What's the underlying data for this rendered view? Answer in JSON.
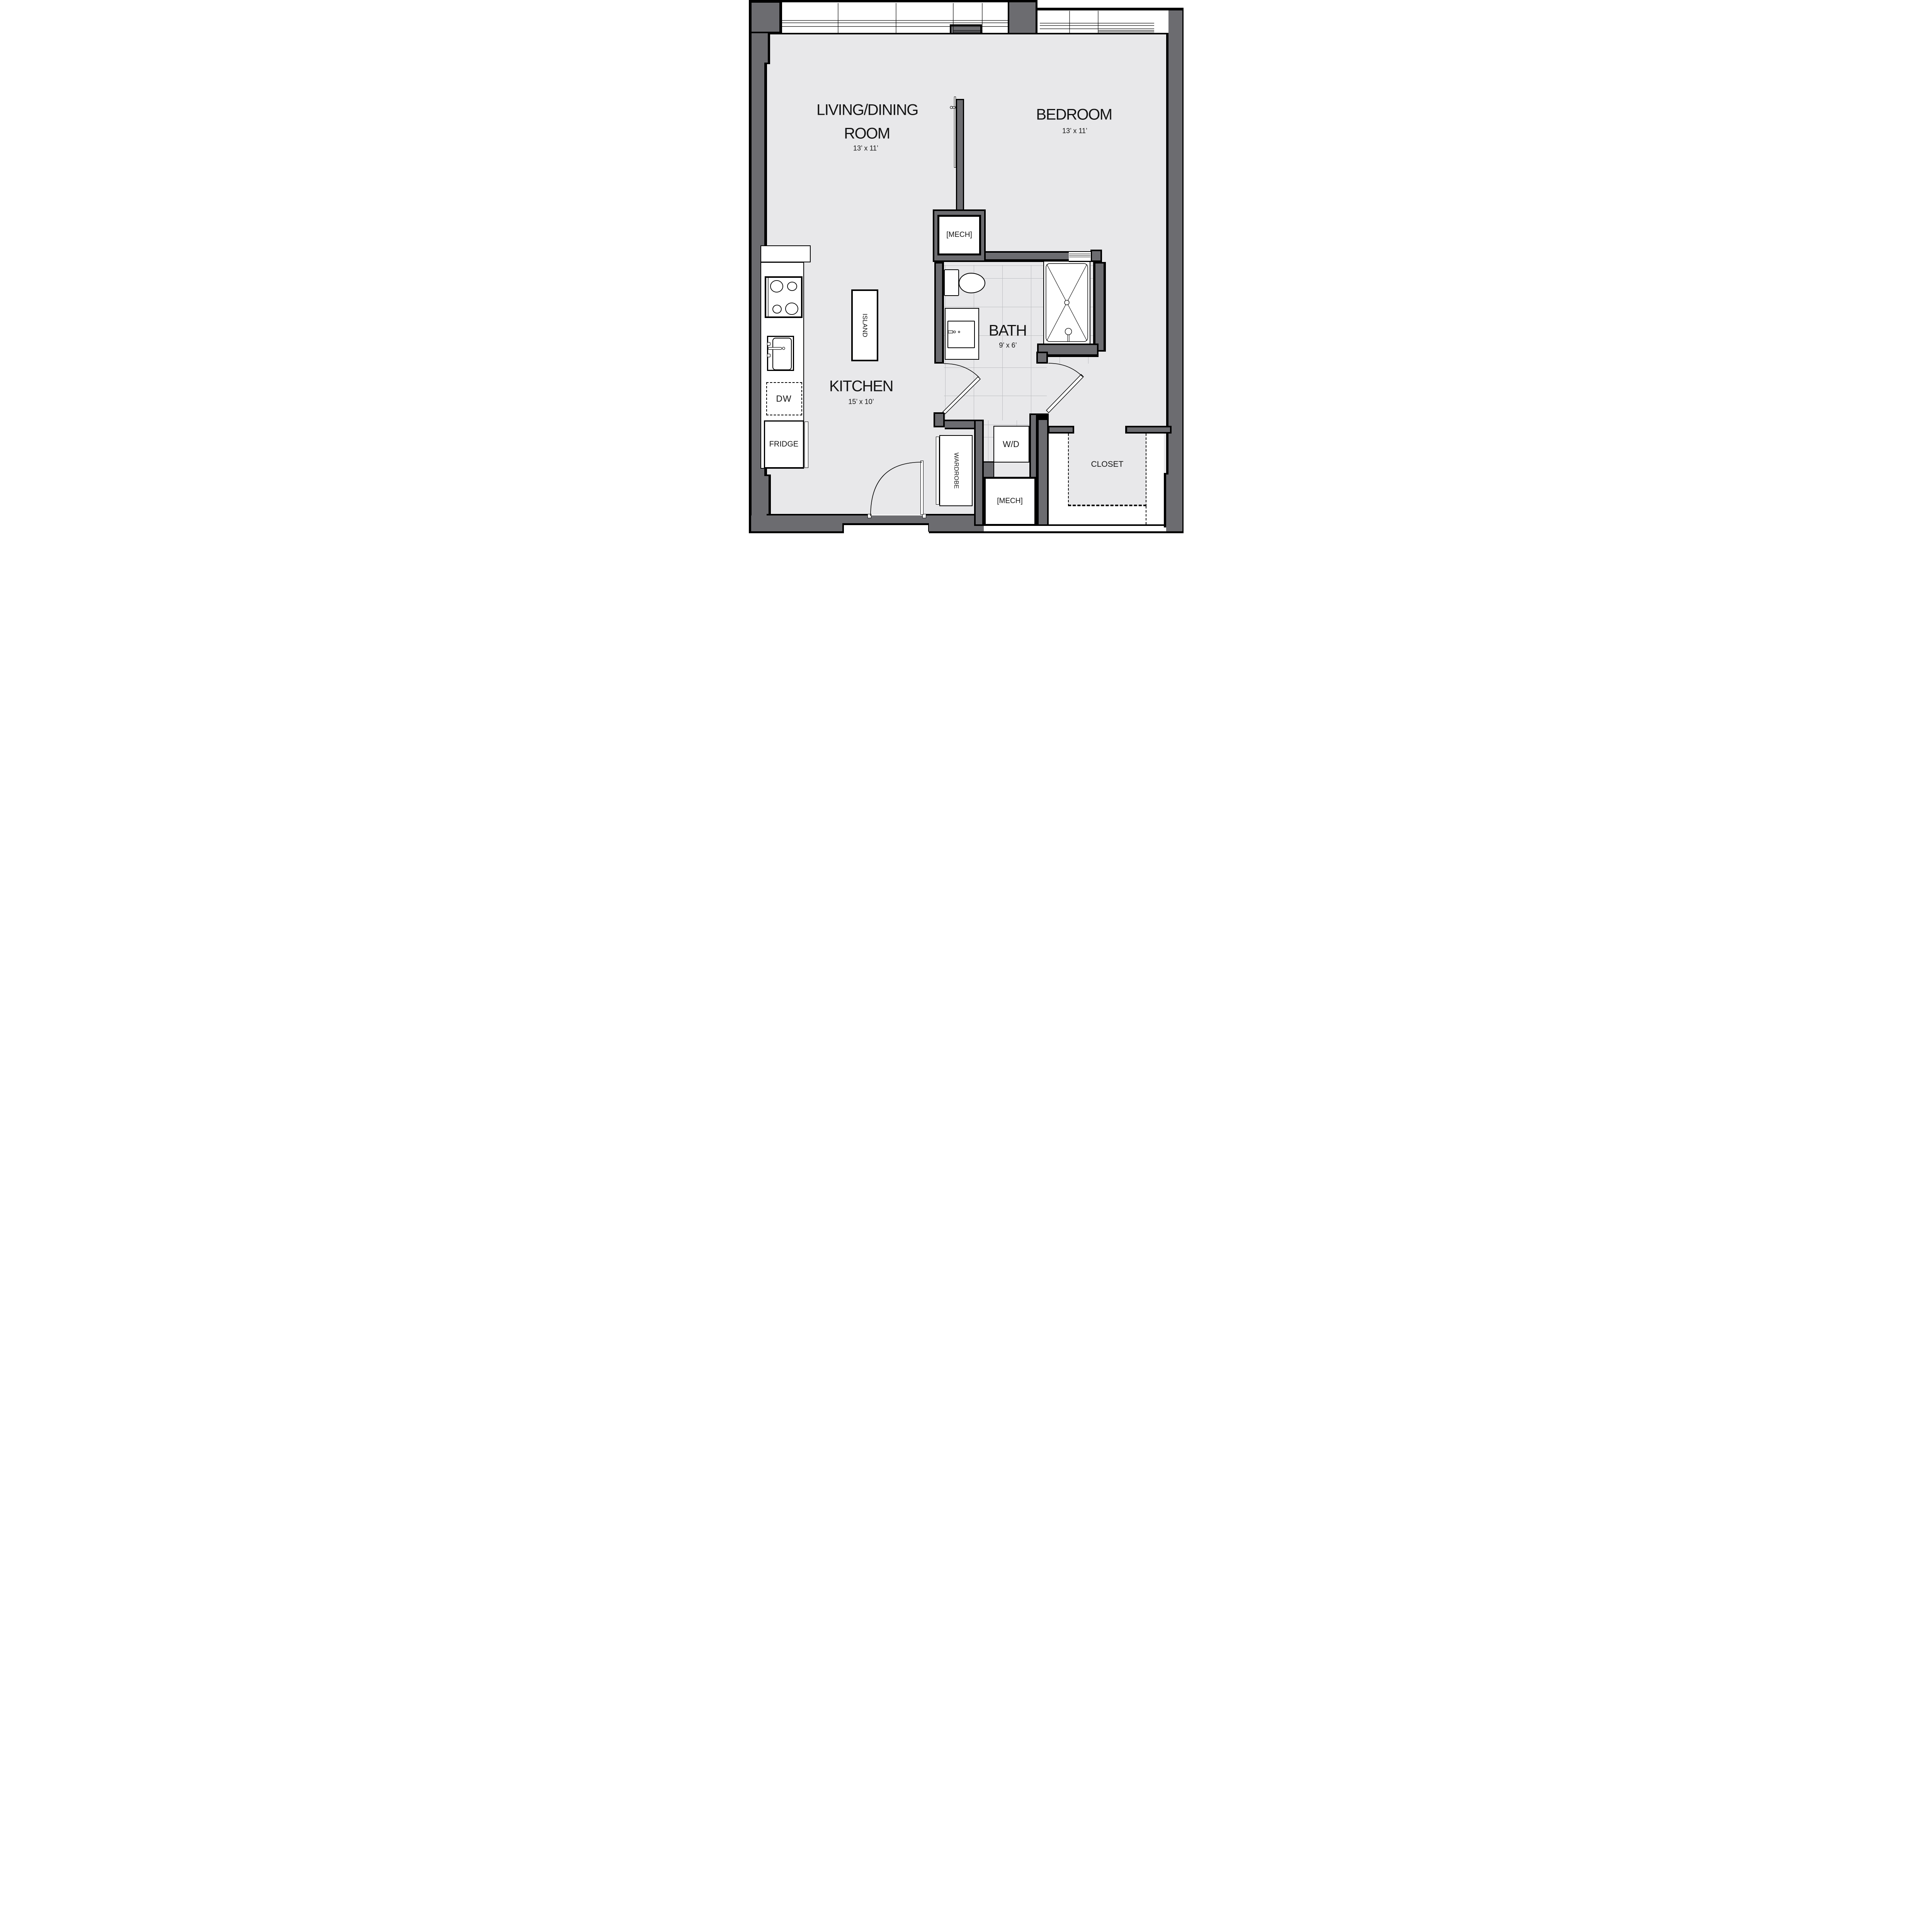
{
  "title": "One-bedroom apartment floor plan",
  "rooms": {
    "living": {
      "line1": "LIVING/DINING",
      "line2": "ROOM",
      "dims": "13’ x 11’"
    },
    "bedroom": {
      "label": "BEDROOM",
      "dims": "13’ x 11’"
    },
    "kitchen": {
      "label": "KITCHEN",
      "dims": "15’ x 10’"
    },
    "bath": {
      "label": "BATH",
      "dims": "9’ x 6’"
    },
    "closet": {
      "label": "CLOSET"
    }
  },
  "fixtures": {
    "mech_upper": "[MECH]",
    "mech_lower": "[MECH]",
    "island": "ISLAND",
    "wardrobe": "WARDROBE",
    "washer_dryer": "W/D",
    "dishwasher": "DW",
    "fridge": "FRIDGE"
  },
  "colors": {
    "wall": "#6c6c70",
    "floor": "#e8e8ea",
    "outline": "#000000",
    "tile": "#bcbdc1",
    "white": "#ffffff"
  }
}
